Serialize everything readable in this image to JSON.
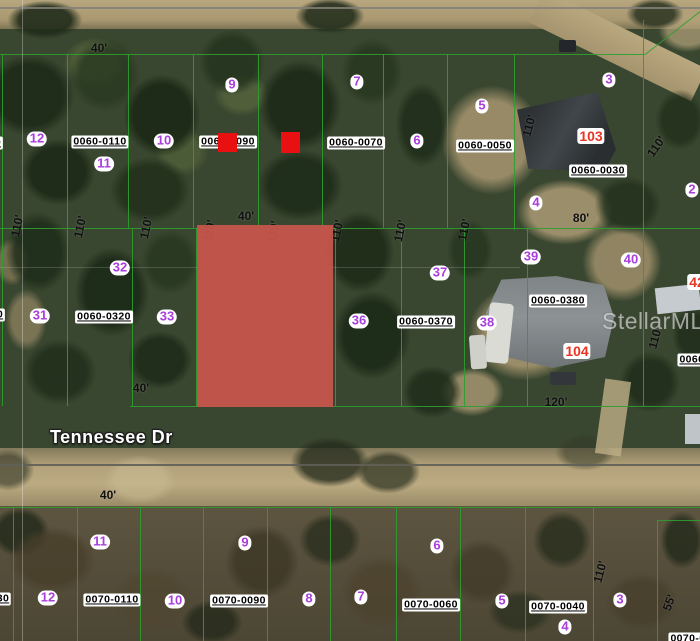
{
  "street": {
    "label": "Tennessee Dr"
  },
  "watermark": {
    "text": "StellarMLS"
  },
  "colors": {
    "boundary": "#2f9e2f",
    "highlight": "#c4544b",
    "marker_red": "#e81010",
    "lot_number": "#a93ede",
    "house_number": "#e93523",
    "dimension": "#101010"
  },
  "highlight_parcel": {
    "x": 197,
    "y": 225,
    "w": 136,
    "h": 182
  },
  "red_markers": [
    {
      "x": 218,
      "y": 133,
      "w": 19,
      "h": 19
    },
    {
      "x": 281,
      "y": 132,
      "w": 19,
      "h": 21
    }
  ],
  "parcel_ids": [
    {
      "text": "0060-0110",
      "x": 100,
      "y": 142
    },
    {
      "text": "0060-0090",
      "x": 228,
      "y": 142
    },
    {
      "text": "0060-0070",
      "x": 356,
      "y": 143
    },
    {
      "text": "0060-0050",
      "x": 485,
      "y": 146
    },
    {
      "text": "0060-0030",
      "x": 598,
      "y": 171
    },
    {
      "text": "0060-0320",
      "x": 104,
      "y": 317
    },
    {
      "text": "0060-0370",
      "x": 426,
      "y": 322
    },
    {
      "text": "0060-0380",
      "x": 558,
      "y": 301
    },
    {
      "text": "0070-0110",
      "x": 112,
      "y": 600
    },
    {
      "text": "0070-0090",
      "x": 239,
      "y": 601
    },
    {
      "text": "0070-0060",
      "x": 431,
      "y": 605
    },
    {
      "text": "0070-0040",
      "x": 558,
      "y": 607
    },
    {
      "text": "0060-0",
      "x": 697,
      "y": 360
    },
    {
      "text": "0070-0",
      "x": 688,
      "y": 639
    },
    {
      "text": "30",
      "x": 3,
      "y": 599
    },
    {
      "text": "0",
      "x": 0,
      "y": 315
    },
    {
      "text": "0",
      "x": -2,
      "y": 143
    }
  ],
  "lot_numbers": [
    {
      "text": "9",
      "x": 232,
      "y": 85
    },
    {
      "text": "7",
      "x": 357,
      "y": 82
    },
    {
      "text": "5",
      "x": 482,
      "y": 106
    },
    {
      "text": "3",
      "x": 609,
      "y": 80
    },
    {
      "text": "12",
      "x": 37,
      "y": 139
    },
    {
      "text": "10",
      "x": 164,
      "y": 141
    },
    {
      "text": "6",
      "x": 417,
      "y": 141
    },
    {
      "text": "11",
      "x": 104,
      "y": 164
    },
    {
      "text": "4",
      "x": 536,
      "y": 203
    },
    {
      "text": "2",
      "x": 692,
      "y": 190
    },
    {
      "text": "32",
      "x": 120,
      "y": 268
    },
    {
      "text": "37",
      "x": 440,
      "y": 273
    },
    {
      "text": "39",
      "x": 531,
      "y": 257
    },
    {
      "text": "40",
      "x": 631,
      "y": 260
    },
    {
      "text": "31",
      "x": 40,
      "y": 316
    },
    {
      "text": "33",
      "x": 167,
      "y": 317
    },
    {
      "text": "36",
      "x": 359,
      "y": 321
    },
    {
      "text": "38",
      "x": 487,
      "y": 323
    },
    {
      "text": "11",
      "x": 100,
      "y": 542
    },
    {
      "text": "9",
      "x": 245,
      "y": 543
    },
    {
      "text": "6",
      "x": 437,
      "y": 546
    },
    {
      "text": "12",
      "x": 48,
      "y": 598
    },
    {
      "text": "10",
      "x": 175,
      "y": 601
    },
    {
      "text": "8",
      "x": 309,
      "y": 599
    },
    {
      "text": "7",
      "x": 361,
      "y": 597
    },
    {
      "text": "5",
      "x": 502,
      "y": 601
    },
    {
      "text": "3",
      "x": 620,
      "y": 600
    },
    {
      "text": "4",
      "x": 565,
      "y": 627
    }
  ],
  "house_numbers": [
    {
      "text": "103",
      "x": 591,
      "y": 136
    },
    {
      "text": "104",
      "x": 577,
      "y": 351
    },
    {
      "text": "42",
      "x": 697,
      "y": 282
    }
  ],
  "dimensions": [
    {
      "text": "40'",
      "x": 99,
      "y": 49,
      "rot": 0
    },
    {
      "text": "40'",
      "x": 246,
      "y": 217,
      "rot": 0
    },
    {
      "text": "40'",
      "x": 141,
      "y": 389,
      "rot": 0
    },
    {
      "text": "40'",
      "x": 108,
      "y": 496,
      "rot": 0
    },
    {
      "text": "80'",
      "x": 581,
      "y": 219,
      "rot": 0
    },
    {
      "text": "120'",
      "x": 556,
      "y": 403,
      "rot": 0
    },
    {
      "text": "110'",
      "x": 18,
      "y": 226,
      "rot": -78
    },
    {
      "text": "110'",
      "x": 81,
      "y": 227,
      "rot": -78
    },
    {
      "text": "110'",
      "x": 147,
      "y": 228,
      "rot": -78
    },
    {
      "text": "110'",
      "x": 210,
      "y": 231,
      "rot": -78
    },
    {
      "text": "110'",
      "x": 274,
      "y": 232,
      "rot": -78
    },
    {
      "text": "110'",
      "x": 338,
      "y": 231,
      "rot": -78
    },
    {
      "text": "110'",
      "x": 401,
      "y": 231,
      "rot": -78
    },
    {
      "text": "110'",
      "x": 465,
      "y": 230,
      "rot": -78
    },
    {
      "text": "110'",
      "x": 530,
      "y": 126,
      "rot": -75
    },
    {
      "text": "110'",
      "x": 657,
      "y": 147,
      "rot": -55
    },
    {
      "text": "110'",
      "x": 656,
      "y": 338,
      "rot": -75
    },
    {
      "text": "110'",
      "x": 601,
      "y": 572,
      "rot": -75
    },
    {
      "text": "55'",
      "x": 670,
      "y": 603,
      "rot": -70
    }
  ],
  "boundaries": {
    "vertical": [
      {
        "x": 2,
        "y1": 54,
        "y2": 228
      },
      {
        "x": 67,
        "y1": 54,
        "y2": 228
      },
      {
        "x": 128,
        "y1": 54,
        "y2": 228
      },
      {
        "x": 193,
        "y1": 54,
        "y2": 228
      },
      {
        "x": 258,
        "y1": 54,
        "y2": 228
      },
      {
        "x": 322,
        "y1": 54,
        "y2": 228
      },
      {
        "x": 383,
        "y1": 54,
        "y2": 228
      },
      {
        "x": 447,
        "y1": 54,
        "y2": 228
      },
      {
        "x": 514,
        "y1": 54,
        "y2": 230
      },
      {
        "x": 643,
        "y1": 20,
        "y2": 406
      },
      {
        "x": 2,
        "y1": 228,
        "y2": 406
      },
      {
        "x": 67,
        "y1": 228,
        "y2": 406
      },
      {
        "x": 132,
        "y1": 228,
        "y2": 406
      },
      {
        "x": 196,
        "y1": 228,
        "y2": 406
      },
      {
        "x": 335,
        "y1": 228,
        "y2": 407
      },
      {
        "x": 401,
        "y1": 228,
        "y2": 407
      },
      {
        "x": 464,
        "y1": 228,
        "y2": 407
      },
      {
        "x": 527,
        "y1": 228,
        "y2": 407
      },
      {
        "x": 13,
        "y1": 507,
        "y2": 641
      },
      {
        "x": 77,
        "y1": 507,
        "y2": 641
      },
      {
        "x": 140,
        "y1": 507,
        "y2": 641
      },
      {
        "x": 203,
        "y1": 507,
        "y2": 641
      },
      {
        "x": 267,
        "y1": 507,
        "y2": 641
      },
      {
        "x": 330,
        "y1": 507,
        "y2": 641
      },
      {
        "x": 396,
        "y1": 507,
        "y2": 641
      },
      {
        "x": 460,
        "y1": 507,
        "y2": 641
      },
      {
        "x": 525,
        "y1": 507,
        "y2": 641
      },
      {
        "x": 593,
        "y1": 507,
        "y2": 641
      },
      {
        "x": 657,
        "y1": 520,
        "y2": 641
      }
    ],
    "horizontal": [
      {
        "x1": 0,
        "x2": 645,
        "y": 54
      },
      {
        "x1": 0,
        "x2": 700,
        "y": 228
      },
      {
        "x1": 130,
        "x2": 700,
        "y": 406
      },
      {
        "x1": 0,
        "x2": 700,
        "y": 507
      },
      {
        "x1": 657,
        "x2": 700,
        "y": 520
      }
    ],
    "diagonal": [
      {
        "x": 645,
        "y": 54,
        "len": 72,
        "angle": -38
      }
    ]
  },
  "misc_lines": [
    {
      "type": "h",
      "x1": 0,
      "x2": 700,
      "y": 7,
      "th": 2,
      "color": "rgba(130,128,120,0.85)"
    },
    {
      "type": "h",
      "x1": 0,
      "x2": 700,
      "y": 464,
      "th": 2,
      "color": "rgba(95,95,88,0.9)"
    },
    {
      "type": "h",
      "x1": 0,
      "x2": 520,
      "y": 267,
      "th": 1,
      "color": "rgba(200,200,200,0.22)"
    },
    {
      "type": "v",
      "x": 22,
      "y1": 0,
      "y2": 641,
      "th": 1,
      "color": "rgba(255,255,255,0.3)"
    }
  ]
}
